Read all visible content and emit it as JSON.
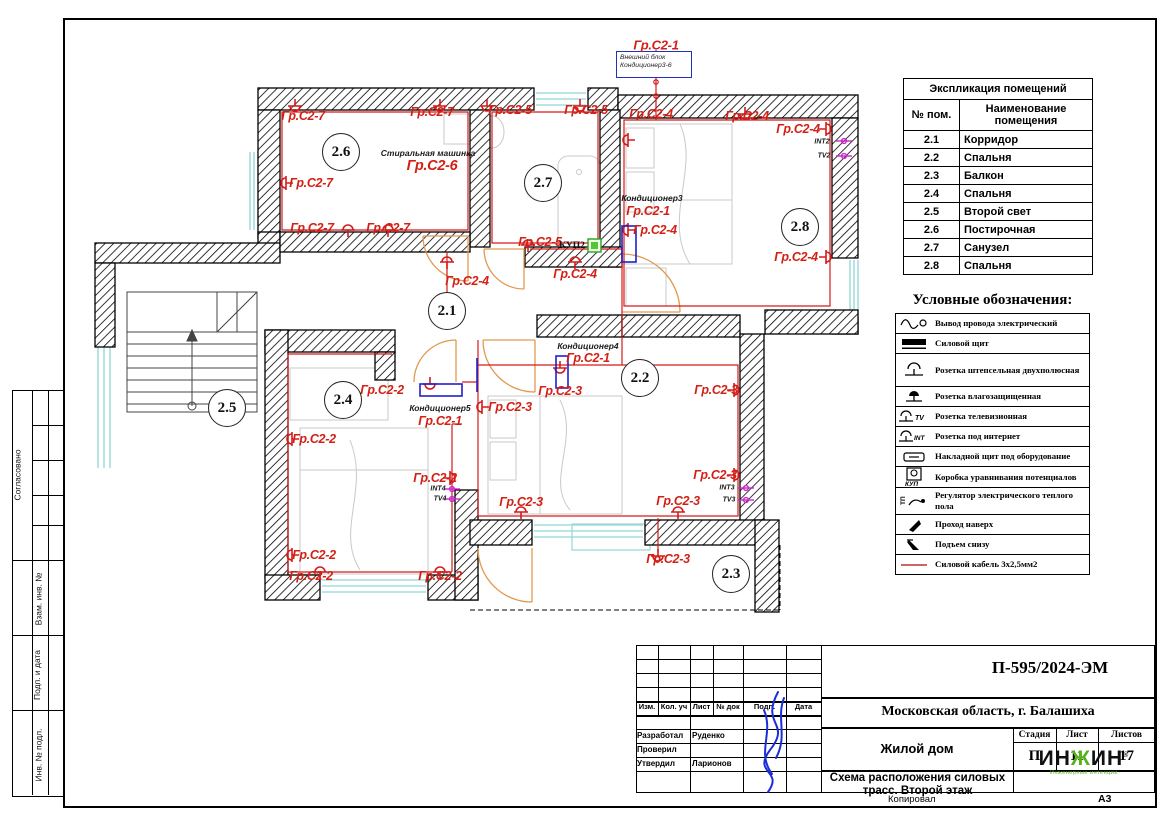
{
  "stamp_left": {
    "agreed": "Согласовано",
    "sections": [
      "Взам. инв. №",
      "Подп. и дата",
      "Инв. № подл."
    ]
  },
  "explication": {
    "title": "Экспликация помещений",
    "col_num": "№ пом.",
    "col_name": "Наименование помещения",
    "rows": [
      {
        "num": "2.1",
        "name": "Корридор"
      },
      {
        "num": "2.2",
        "name": "Спальня"
      },
      {
        "num": "2.3",
        "name": "Балкон"
      },
      {
        "num": "2.4",
        "name": "Спальня"
      },
      {
        "num": "2.5",
        "name": "Второй свет"
      },
      {
        "num": "2.6",
        "name": "Постирочная"
      },
      {
        "num": "2.7",
        "name": "Санузел"
      },
      {
        "num": "2.8",
        "name": "Спальня"
      }
    ]
  },
  "legend": {
    "title": "Условные обозначения:",
    "items": [
      {
        "icon": "wire-output-icon",
        "label": "Вывод провода электрический"
      },
      {
        "icon": "power-panel-icon",
        "label": "Силовой щит"
      },
      {
        "icon": "socket-icon",
        "label": "Розетка штепсельная двухполюсная"
      },
      {
        "icon": "socket-waterproof-icon",
        "label": "Розетка влагозащищенная"
      },
      {
        "icon": "socket-tv-icon",
        "label": "Розетка телевизионная"
      },
      {
        "icon": "socket-internet-icon",
        "label": "Розетка под интернет"
      },
      {
        "icon": "surface-panel-icon",
        "label": "Накладной щит под оборудование"
      },
      {
        "icon": "kup-box-icon",
        "label": "Коробка уравнивания потенциалов"
      },
      {
        "icon": "floor-heating-regulator-icon",
        "label": "Регулятор электрического теплого пола"
      },
      {
        "icon": "pass-up-icon",
        "label": "Проход наверх"
      },
      {
        "icon": "rise-below-icon",
        "label": "Подъем снизу"
      },
      {
        "icon": "power-cable-icon",
        "label": "Силовой кабель 3х2,5мм2"
      }
    ]
  },
  "titleblock": {
    "code": "П-595/2024-ЭМ",
    "location": "Московская область, г. Балашиха",
    "object": "Жилой дом",
    "sheet_title": "Схема расположения силовых трасс. Второй этаж",
    "cols": [
      "Изм.",
      "Кол. уч",
      "Лист",
      "№ док",
      "Подп.",
      "Дата"
    ],
    "roles": [
      {
        "role": "Разработал",
        "name": "Руденко"
      },
      {
        "role": "Проверил",
        "name": ""
      },
      {
        "role": "Утвердил",
        "name": "Ларионов"
      }
    ],
    "stage_label": "Стадия",
    "sheet_label": "Лист",
    "sheets_label": "Листов",
    "stage": "П",
    "sheet": "11",
    "sheets": "17",
    "copied": "Копировал",
    "format": "А3",
    "logo": {
      "p1": "ИН",
      "zh": "Ж",
      "p2": "ИН",
      "reg": "®",
      "sub": "Инженерные интенции"
    }
  },
  "plan": {
    "outdoor_unit": {
      "line1": "Внешний блок",
      "line2": "Кондиционер3-6"
    },
    "group_labels": [
      {
        "t": "Гр.С2-1",
        "x": 656,
        "y": 45,
        "s": 13
      },
      {
        "t": "Гр.С2-7",
        "x": 303,
        "y": 116
      },
      {
        "t": "Гр.С2-7",
        "x": 432,
        "y": 112
      },
      {
        "t": "Гр.С2-7",
        "x": 311,
        "y": 183
      },
      {
        "t": "Гр.С2-7",
        "x": 312,
        "y": 228
      },
      {
        "t": "Гр.С2-7",
        "x": 388,
        "y": 228
      },
      {
        "t": "Гр.С2-6",
        "x": 432,
        "y": 166,
        "s": 14.5
      },
      {
        "t": "Гр.С2-5",
        "x": 510,
        "y": 110
      },
      {
        "t": "Гр.С2-5",
        "x": 586,
        "y": 110
      },
      {
        "t": "Гр.С2-5",
        "x": 540,
        "y": 242
      },
      {
        "t": "Гр.С2-4",
        "x": 651,
        "y": 114
      },
      {
        "t": "Гр.С2-4",
        "x": 747,
        "y": 116
      },
      {
        "t": "Гр.С2-4",
        "x": 798,
        "y": 129
      },
      {
        "t": "Гр.С2-1",
        "x": 648,
        "y": 211
      },
      {
        "t": "Гр.С2-4",
        "x": 655,
        "y": 230
      },
      {
        "t": "Гр.С2-4",
        "x": 796,
        "y": 257
      },
      {
        "t": "Гр.С2-4",
        "x": 467,
        "y": 281
      },
      {
        "t": "Гр.С2-4",
        "x": 575,
        "y": 274
      },
      {
        "t": "Гр.С2-1",
        "x": 588,
        "y": 358
      },
      {
        "t": "Гр.С2-2",
        "x": 382,
        "y": 390
      },
      {
        "t": "Гр.С2-1",
        "x": 440,
        "y": 421
      },
      {
        "t": "Гр.С2-2",
        "x": 314,
        "y": 439
      },
      {
        "t": "Гр.С2-2",
        "x": 435,
        "y": 478
      },
      {
        "t": "Гр.С2-2",
        "x": 314,
        "y": 555
      },
      {
        "t": "Гр.С2-2",
        "x": 311,
        "y": 576
      },
      {
        "t": "Гр.С2-2",
        "x": 440,
        "y": 576
      },
      {
        "t": "Гр.С2-3",
        "x": 560,
        "y": 391
      },
      {
        "t": "Гр.С2-3",
        "x": 510,
        "y": 407
      },
      {
        "t": "Гр.С2-3",
        "x": 716,
        "y": 390
      },
      {
        "t": "Гр.С2-3",
        "x": 715,
        "y": 475
      },
      {
        "t": "Гр.С2-3",
        "x": 521,
        "y": 502
      },
      {
        "t": "Гр.С2-3",
        "x": 678,
        "y": 501
      },
      {
        "t": "Гр.С2-3",
        "x": 668,
        "y": 559
      }
    ],
    "note_labels": [
      {
        "t": "Стиральная машинка",
        "x": 428,
        "y": 153
      },
      {
        "t": "Кондиционер3",
        "x": 652,
        "y": 198
      },
      {
        "t": "Кондиционер4",
        "x": 588,
        "y": 346
      },
      {
        "t": "Кондиционер5",
        "x": 440,
        "y": 408
      }
    ],
    "kup_label": {
      "t": "КУП2",
      "x": 572,
      "y": 246
    },
    "port_labels": [
      {
        "t": "INT2",
        "x": 822,
        "y": 142
      },
      {
        "t": "TV2",
        "x": 824,
        "y": 156
      },
      {
        "t": "INT3",
        "x": 727,
        "y": 488
      },
      {
        "t": "TV3",
        "x": 729,
        "y": 500
      },
      {
        "t": "INT4",
        "x": 438,
        "y": 489
      },
      {
        "t": "TV4",
        "x": 440,
        "y": 499
      }
    ],
    "rooms": [
      {
        "n": "2.1",
        "x": 447,
        "y": 311
      },
      {
        "n": "2.2",
        "x": 640,
        "y": 378
      },
      {
        "n": "2.3",
        "x": 731,
        "y": 574
      },
      {
        "n": "2.4",
        "x": 343,
        "y": 400
      },
      {
        "n": "2.5",
        "x": 227,
        "y": 408
      },
      {
        "n": "2.6",
        "x": 341,
        "y": 152
      },
      {
        "n": "2.7",
        "x": 543,
        "y": 183
      },
      {
        "n": "2.8",
        "x": 800,
        "y": 227
      }
    ]
  }
}
